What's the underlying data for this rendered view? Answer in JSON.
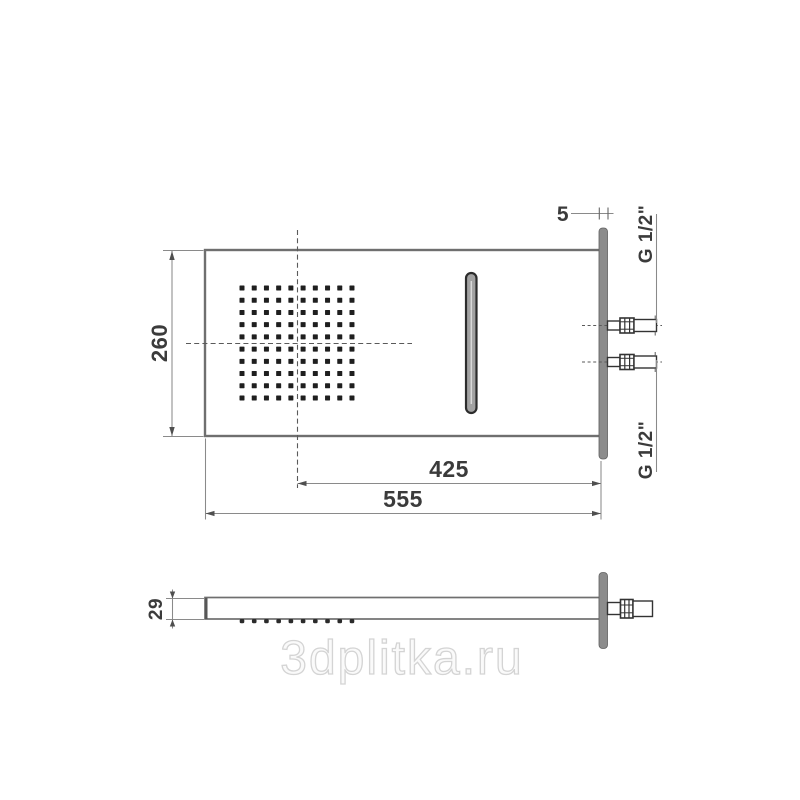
{
  "front_view": {
    "dim_height": "260",
    "dim_plate_thickness": "5",
    "dim_center_to_edge": "425",
    "dim_total_width": "555",
    "thread_label_top": "G 1/2\"",
    "thread_label_bottom": "G 1/2\"",
    "nozzle_grid": {
      "rows": 10,
      "cols": 10
    }
  },
  "side_view": {
    "dim_depth": "29",
    "teeth_count": 10
  },
  "watermark": {
    "text": "3dplitka.ru",
    "color": "#d4d4d4"
  },
  "colors": {
    "outline": "#6f6f6f",
    "dark_detail": "#1f1f1f",
    "plate_fill": "#8c8c8c"
  }
}
